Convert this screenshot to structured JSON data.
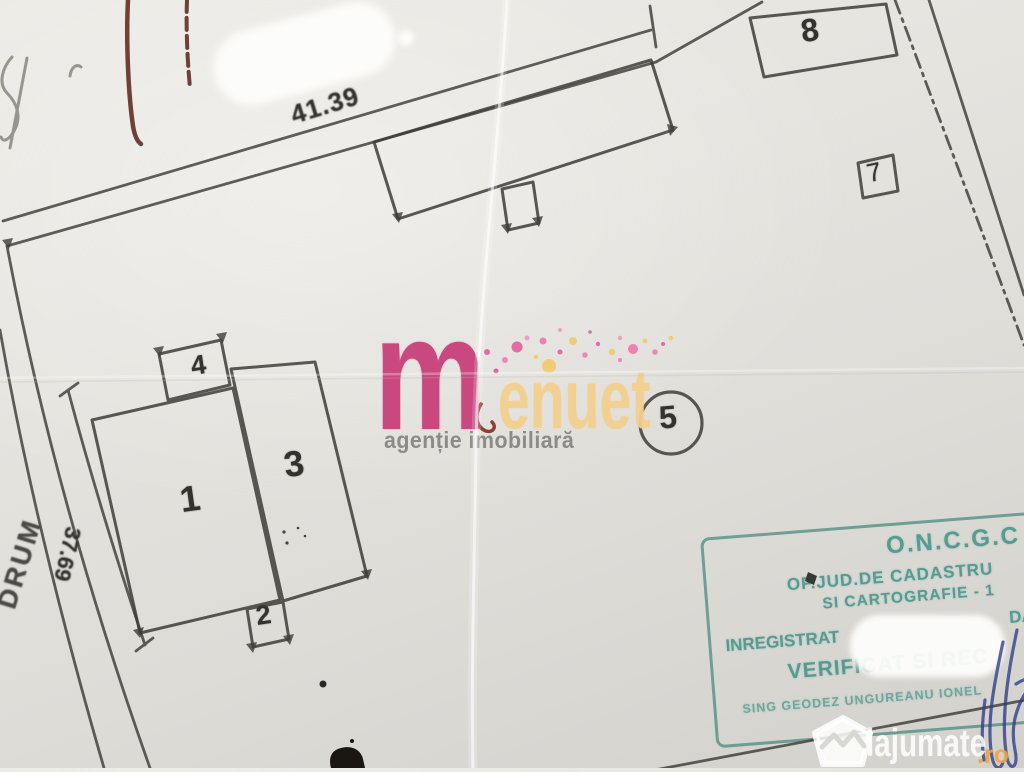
{
  "plan": {
    "dim_top": "41.39",
    "dim_left": "37.69",
    "road": "DRUM",
    "labels": {
      "b1": "1",
      "b2": "2",
      "b3": "3",
      "b4": "4",
      "p5": "5",
      "p7": "7",
      "p8": "8"
    }
  },
  "logo": {
    "m": "m",
    "rest": "enuet",
    "tagline": "agenție imobiliară"
  },
  "stamp": {
    "org": "O.N.C.G.C",
    "office": "OF.JUD.DE CADASTRU",
    "office2": "SI CARTOGRAFIE - 1",
    "registered": "INREGISTRAT",
    "registered_right": "DA",
    "verified": "VERIFICAT SI REC",
    "engineer": "SING GEODEZ UNGUREANU IONEL"
  },
  "watermark": {
    "brand": "lajumate",
    "tld": ".ro"
  },
  "colors": {
    "paper": "#e3e1dc",
    "ink": "#3f3d38",
    "logo_pink": "#c9487f",
    "logo_cream": "#f2d08e",
    "tagline_gray": "#8d8b88",
    "stamp_teal": "#43948a",
    "watermark_orange": "#f5a33c",
    "signature_blue": "#2c3d8a",
    "red_pen": "#551a10"
  }
}
